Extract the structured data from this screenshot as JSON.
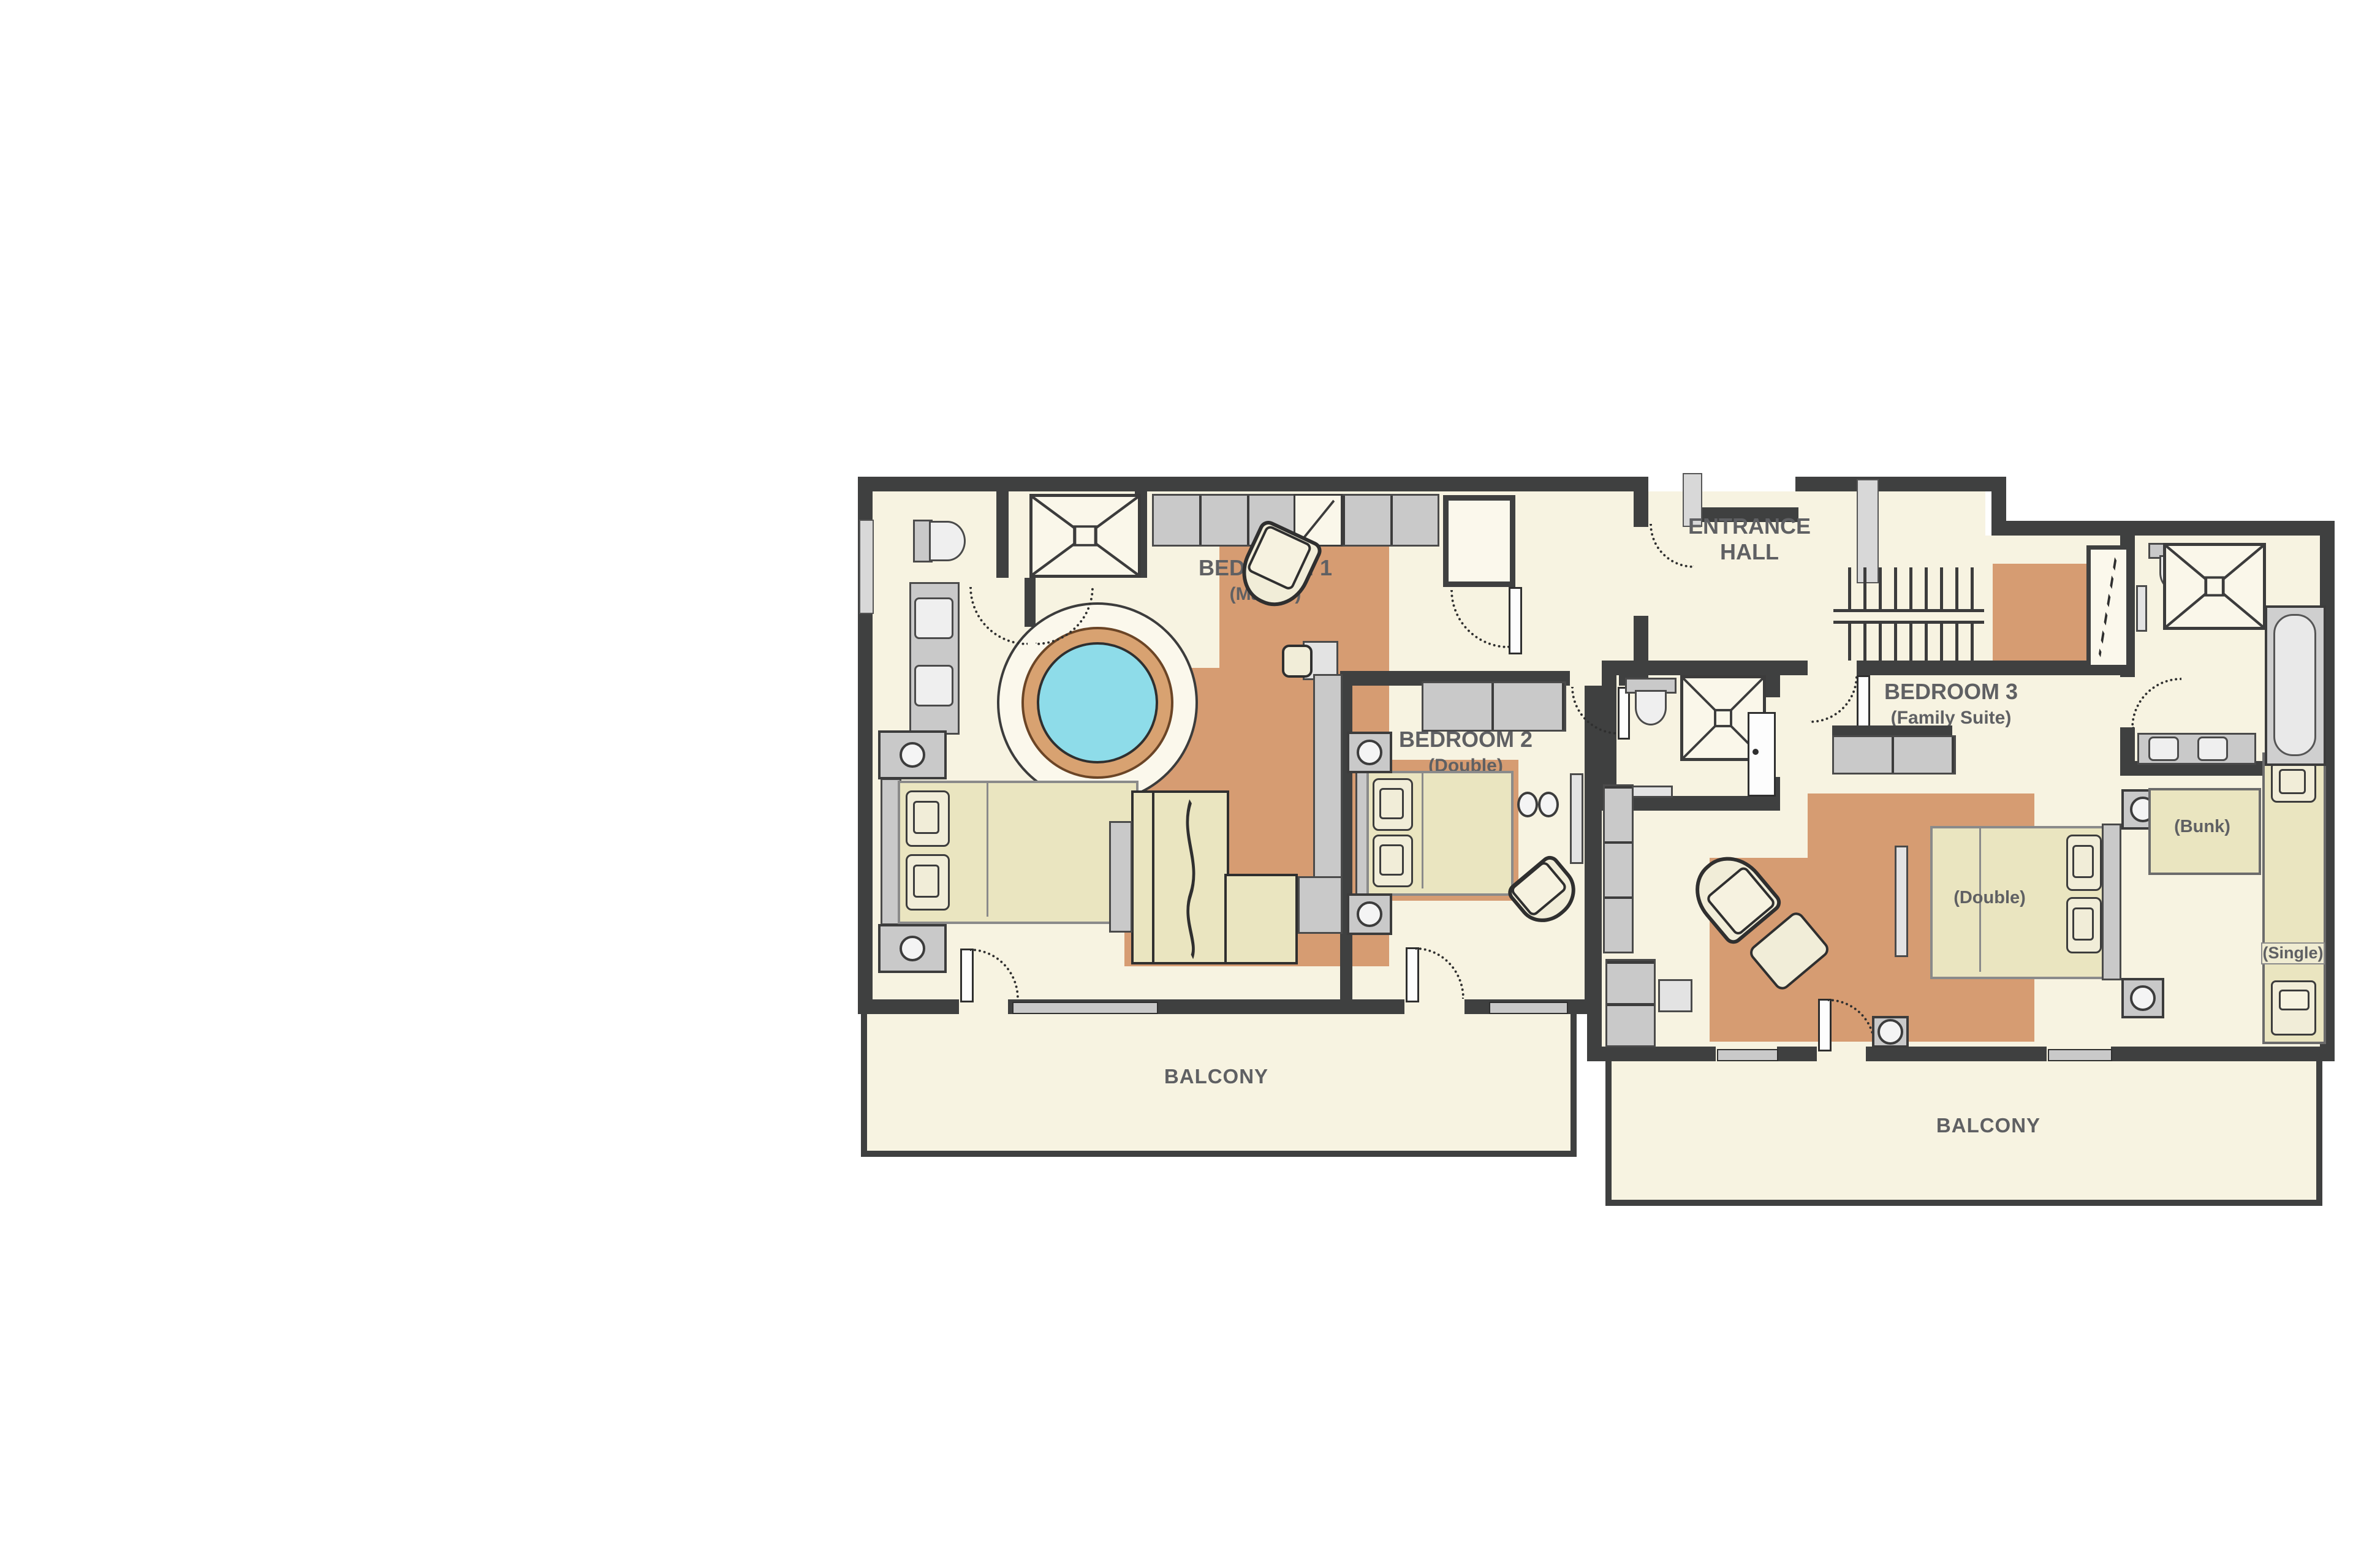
{
  "title": "Chalet upper floor plan",
  "theme": {
    "wall": "#3f4040",
    "floor": "#f7f3e1",
    "rug": "#d69c72",
    "furn": "#c9c9c9",
    "bed": "#eae5c0",
    "pillow": "#f1edd8",
    "water": "#8edce9",
    "label": "#5f6063"
  },
  "rooms": {
    "bedroom1": {
      "name": "BEDROOM 1",
      "sub": "(Master)"
    },
    "bedroom2": {
      "name": "BEDROOM 2",
      "sub": "(Double)"
    },
    "bedroom3": {
      "name": "BEDROOM 3",
      "sub": "(Family Suite)"
    },
    "entrance_hall": {
      "name": "ENTRANCE HALL"
    },
    "balcony_left": {
      "name": "BALCONY"
    },
    "balcony_right": {
      "name": "BALCONY"
    }
  },
  "beds": {
    "double": "(Double)",
    "bunk": "(Bunk)",
    "single": "(Single)"
  }
}
